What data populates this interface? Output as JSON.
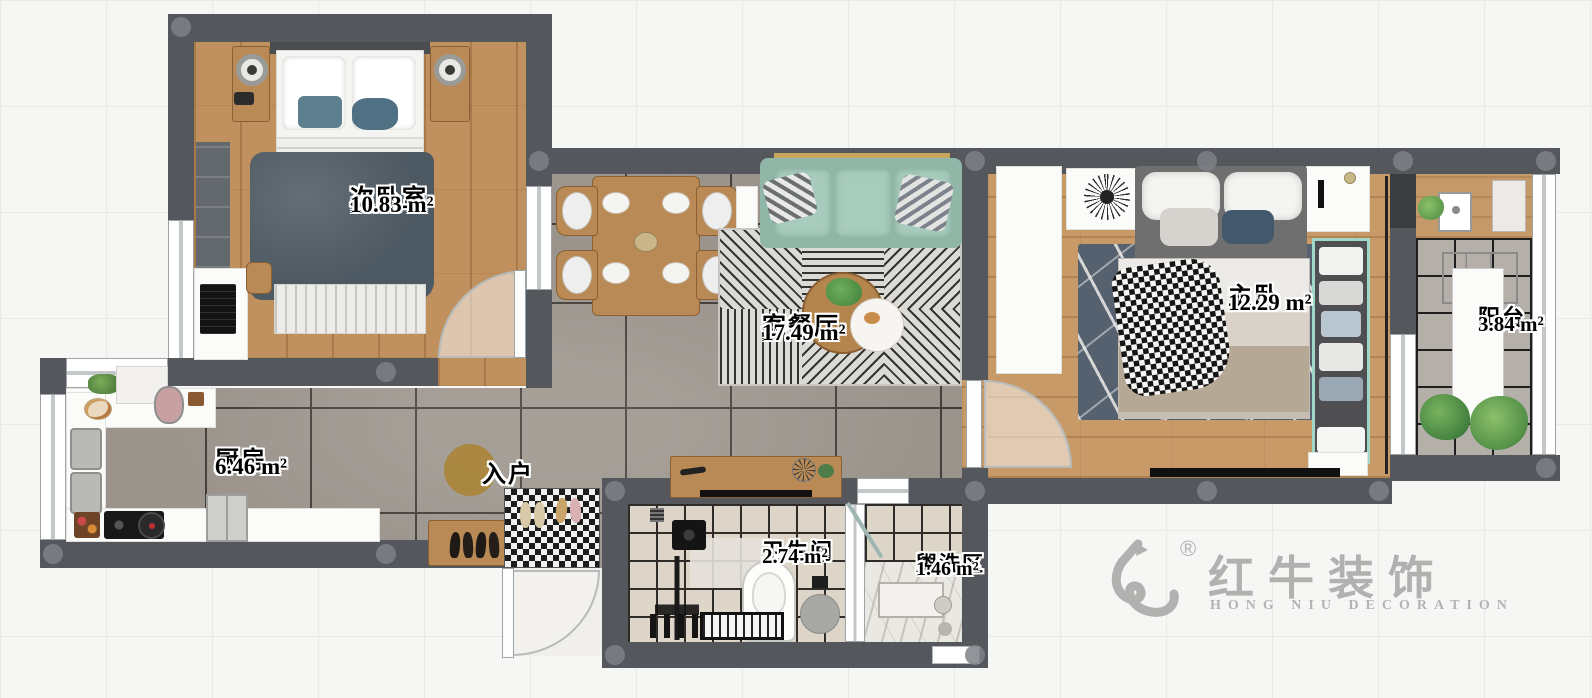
{
  "rooms": {
    "secondary_bedroom": {
      "name": "次卧室",
      "area": "10.83 m²"
    },
    "living_dining": {
      "name": "客餐厅",
      "area": "17.49 m²"
    },
    "kitchen": {
      "name": "厨房",
      "area": "6.46 m²"
    },
    "entry": {
      "name": "入户",
      "area": ""
    },
    "bathroom": {
      "name": "卫生间",
      "area": "2.74 m²"
    },
    "washing_area": {
      "name": "盥洗区",
      "area": "1.46 m²"
    },
    "master_bedroom": {
      "name": "主卧",
      "area": "12.29 m²"
    },
    "balcony": {
      "name": "阳台",
      "area": "3.84 m²"
    }
  },
  "watermark": {
    "brand_cn": "红牛装饰",
    "brand_en": "HONG NIU DECORATION",
    "registered": "®"
  },
  "colors": {
    "wall": "#54575b",
    "wood_floor": "#c0905e",
    "master_wood_floor": "#c89a68",
    "tile_gray": "#9b948c",
    "bath_tile": "#ddd6c8",
    "balcony_tile": "#b4b0a9",
    "sofa_mint": "#a7cbbc",
    "entry_gold": "#aa8433",
    "watermark_gray": "#a5a5a5"
  }
}
